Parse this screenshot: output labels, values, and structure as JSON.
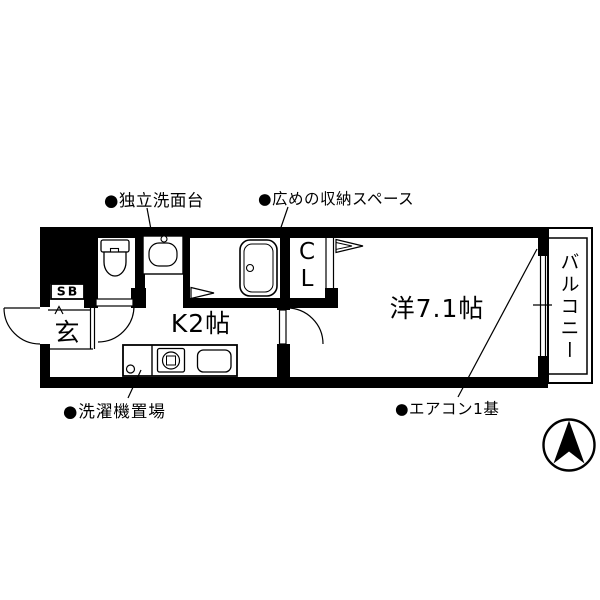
{
  "plan": {
    "labels": {
      "washbasin": "●独立洗面台",
      "storage": "●広めの収納スペース",
      "washer": "●洗濯機置場",
      "aircon": "●エアコン1基"
    },
    "rooms": {
      "kitchen": "K2帖",
      "western": "洋7.1帖",
      "genkan": "玄",
      "shoe_box": "SB",
      "closet_top": "C",
      "closet_bottom": "L",
      "balcony": "バルコニー"
    },
    "icons": {
      "compass": "north-arrow",
      "toilet": "toilet-plan-symbol",
      "bathtub": "bathtub-plan-symbol",
      "washbasin": "basin-plan-symbol",
      "stove": "single-burner-plan-symbol",
      "sink": "kitchen-sink-plan-symbol"
    },
    "colors": {
      "wall": "#000000",
      "background": "#ffffff",
      "line": "#000000"
    }
  }
}
